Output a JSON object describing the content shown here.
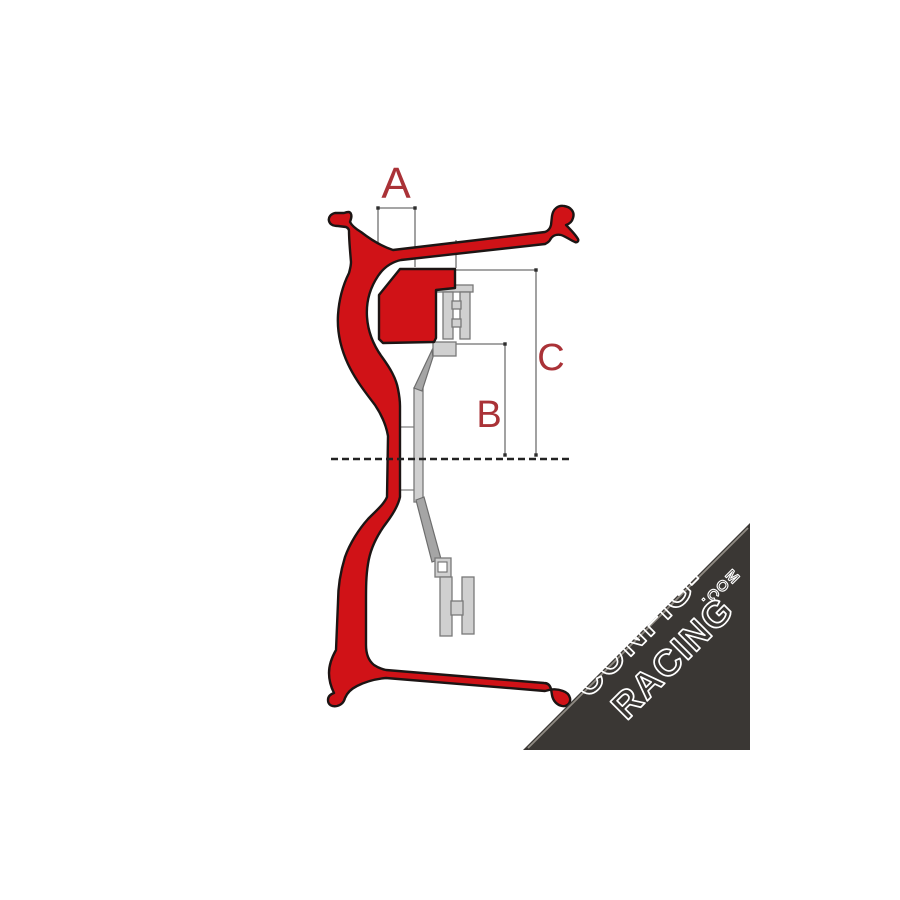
{
  "diagram": {
    "title": "wheel-rim-cross-section-with-offset-dimensions",
    "labels": {
      "a": "A",
      "b": "B",
      "c": "C"
    },
    "colors": {
      "rim_fill": "#d01217",
      "rim_outline": "#1c1514",
      "hub_fill": "#d0d0d0",
      "hub_fill_dark": "#a5a5a5",
      "hub_outline": "#787878",
      "dimension_line": "#6f6f6f",
      "dimension_marker": "#2e2e2e",
      "centerline": "#222222",
      "label_color": "#aa3237",
      "background": "#ffffff"
    }
  },
  "watermark": {
    "line1": "CONFIG-",
    "line2": "RACING",
    "suffix": ".COM",
    "background": "#3a3734",
    "text_color": "#ffffff"
  }
}
